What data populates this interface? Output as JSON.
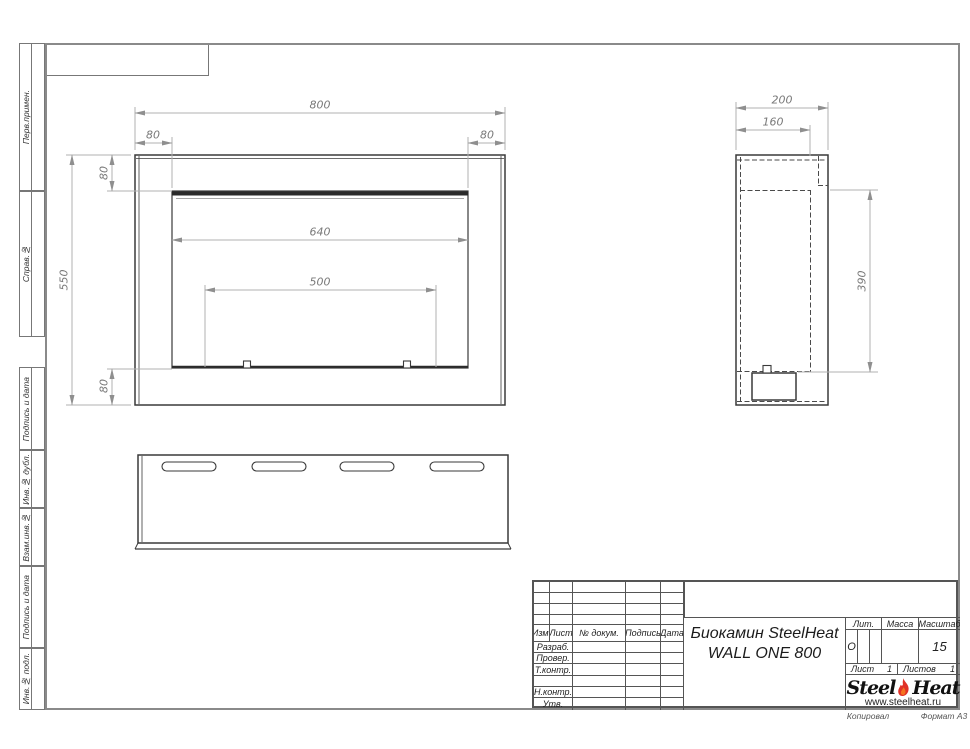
{
  "sidebar": {
    "labels": [
      "Перв.примен.",
      "Справ.№",
      "Подпись и дата",
      "Инв.№ дубл.",
      "Взам.инв.№",
      "Подпись и дата",
      "Инв.№ подл."
    ]
  },
  "dims": {
    "front_width": "800",
    "front_margin_left": "80",
    "front_margin_right": "80",
    "front_opening": "640",
    "front_burner": "500",
    "front_height": "550",
    "front_top": "80",
    "front_bottom": "80",
    "side_depth": "200",
    "side_inner_depth": "160",
    "side_opening_height": "390"
  },
  "title_block": {
    "cols": [
      "Изм.",
      "Лист",
      "№ докум.",
      "Подпись",
      "Дата"
    ],
    "rows": [
      "Разраб.",
      "Провер.",
      "Т.контр.",
      "",
      "Н.контр.",
      "Утв."
    ],
    "doc_title_line1": "Биокамин SteelHeat",
    "doc_title_line2": "WALL ONE 800",
    "lit_label": "Лит.",
    "lit_value": "О",
    "massa_label": "Масса",
    "masshtab_label": "Масштаб",
    "masshtab_value": "15",
    "list_label": "Лист",
    "list_value": "1",
    "listov_label": "Листов",
    "listov_value": "1",
    "logo_steel": "Steel",
    "logo_heat": "Heat",
    "logo_url": "www.steelheat.ru",
    "kopiroval": "Копировал",
    "format": "Формат А3"
  },
  "colors": {
    "outline": "#3a3a3a",
    "dimension": "#a8a8a8",
    "flame_red": "#e03127"
  }
}
